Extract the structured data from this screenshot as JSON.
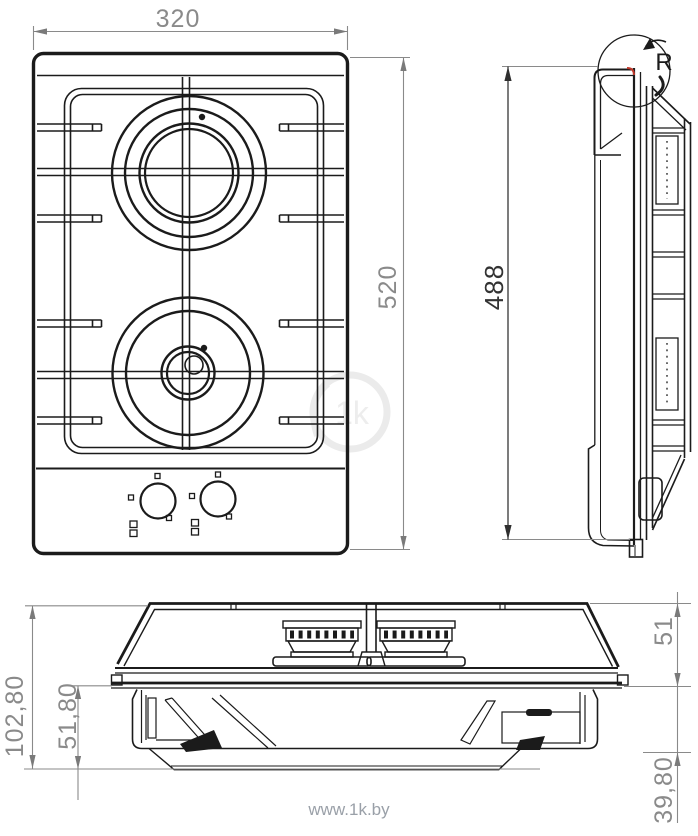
{
  "views": {
    "top": {
      "width_label": "320",
      "depth_label": "520"
    },
    "side": {
      "height_label": "488",
      "detail_label": "R"
    },
    "front": {
      "total_height_label": "102,80",
      "below_top_label": "51,80",
      "above_top_label": "51",
      "tub_depth_label": "39,80"
    }
  },
  "watermark": {
    "text": "www.1k.by",
    "logo_text": "1k"
  },
  "colors": {
    "line": "#1b1b1b",
    "dim_line": "#8a8a8a",
    "dim_text": "#8a8a8a",
    "dim_dark_text": "#333333",
    "accent_red": "#c0392b",
    "watermark": "#9aa0a8"
  }
}
